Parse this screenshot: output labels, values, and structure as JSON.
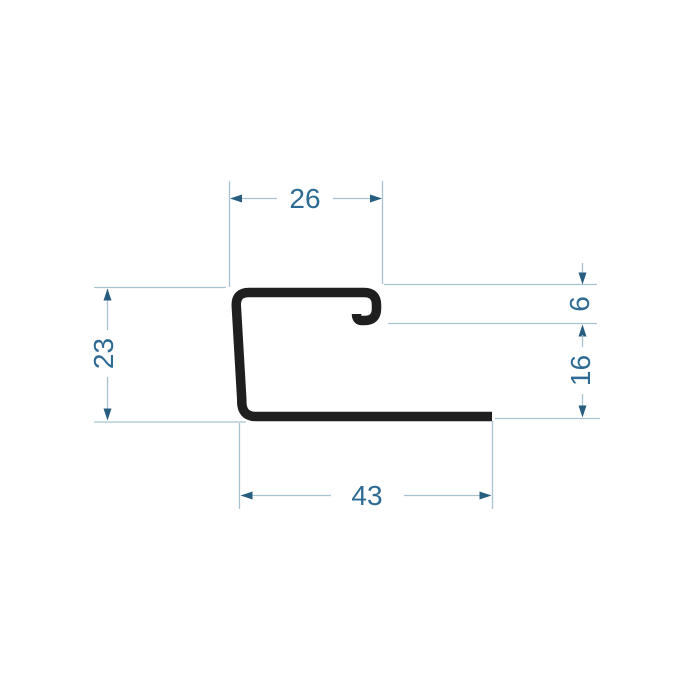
{
  "drawing": {
    "title": "profile-cross-section",
    "type": "technical dimension drawing of a J-trim metal profile",
    "dimensions": {
      "top_width": {
        "value": "26",
        "orientation": "horizontal",
        "position": "top"
      },
      "left_height": {
        "value": "23",
        "orientation": "vertical",
        "position": "left"
      },
      "hook_depth": {
        "value": "6",
        "orientation": "vertical",
        "position": "right-upper"
      },
      "right_inner_height": {
        "value": "16",
        "orientation": "vertical",
        "position": "right-lower"
      },
      "bottom_width": {
        "value": "43",
        "orientation": "horizontal",
        "position": "bottom"
      }
    },
    "colors": {
      "background": "#ffffff",
      "profile_stroke": "#1f1f1f",
      "dimension_line": "#a9c2d0",
      "arrowhead": "#275d80",
      "dimension_text": "#2e6b94"
    }
  }
}
